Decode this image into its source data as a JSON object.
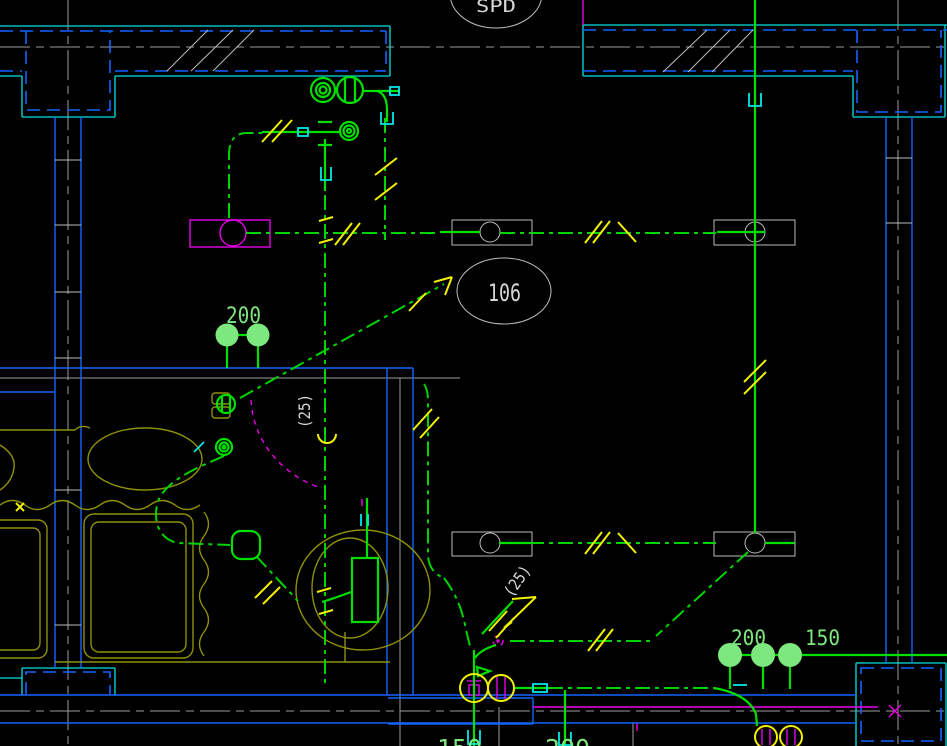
{
  "drawing": {
    "labels": {
      "riser_tag": "SPD",
      "room_number": "106",
      "sprinkler_left": "200",
      "pipe_size_mid": "(25)",
      "pipe_size_low": "(25)",
      "sprinkler_right_200": "200",
      "sprinkler_right_150": "150",
      "bottom_edge_150": "150",
      "bottom_edge_200": "200"
    },
    "colors": {
      "background": "#000000",
      "pipe_green": "#00d400",
      "bright_green": "#00e000",
      "sprinkler_fill_green": "#7de87d",
      "wall_cyan": "#00e0e0",
      "wall_blue": "#1464ff",
      "centerline_gray": "#9b9b9b",
      "fixture_white": "#bdbdbd",
      "fixture_olive": "#8f8f0a",
      "annotation_yellow": "#f2f200",
      "accent_magenta": "#e800e8",
      "text_white": "#d8d8d8"
    }
  }
}
